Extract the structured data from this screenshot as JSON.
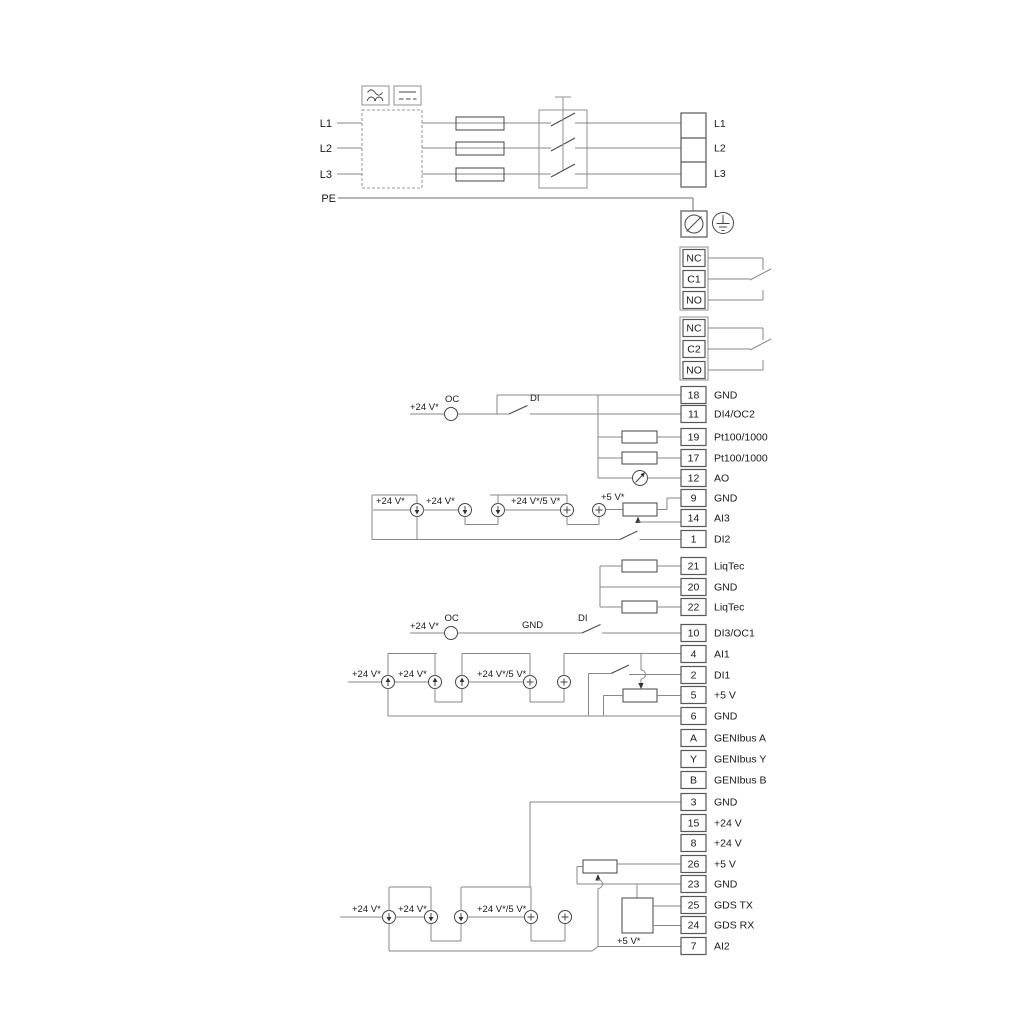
{
  "colors": {
    "background": "#ffffff",
    "wire": "#878787",
    "symbol": "#454545",
    "text": "#1a1a1a"
  },
  "power_input": {
    "lines": [
      "L1",
      "L2",
      "L3"
    ],
    "pe": "PE"
  },
  "power_output": {
    "lines": [
      "L1",
      "L2",
      "L3"
    ]
  },
  "relays": [
    {
      "t": [
        "NC",
        "C1",
        "NO"
      ]
    },
    {
      "t": [
        "NC",
        "C2",
        "NO"
      ]
    }
  ],
  "terminals": [
    {
      "n": "18",
      "l": "GND"
    },
    {
      "n": "11",
      "l": "DI4/OC2"
    },
    {
      "n": "19",
      "l": "Pt100/1000"
    },
    {
      "n": "17",
      "l": "Pt100/1000"
    },
    {
      "n": "12",
      "l": "AO"
    },
    {
      "n": "9",
      "l": "GND"
    },
    {
      "n": "14",
      "l": "AI3"
    },
    {
      "n": "1",
      "l": "DI2"
    },
    {
      "n": "21",
      "l": "LiqTec"
    },
    {
      "n": "20",
      "l": "GND"
    },
    {
      "n": "22",
      "l": "LiqTec"
    },
    {
      "n": "10",
      "l": "DI3/OC1"
    },
    {
      "n": "4",
      "l": "AI1"
    },
    {
      "n": "2",
      "l": "DI1"
    },
    {
      "n": "5",
      "l": "+5 V"
    },
    {
      "n": "6",
      "l": "GND"
    },
    {
      "n": "A",
      "l": "GENIbus A"
    },
    {
      "n": "Y",
      "l": "GENIbus Y"
    },
    {
      "n": "B",
      "l": "GENIbus B"
    },
    {
      "n": "3",
      "l": "GND"
    },
    {
      "n": "15",
      "l": "+24 V"
    },
    {
      "n": "8",
      "l": "+24 V"
    },
    {
      "n": "26",
      "l": "+5 V"
    },
    {
      "n": "23",
      "l": "GND"
    },
    {
      "n": "25",
      "l": "GDS TX"
    },
    {
      "n": "24",
      "l": "GDS RX"
    },
    {
      "n": "7",
      "l": "AI2"
    }
  ],
  "wire_labels": {
    "v24": "+24 V*",
    "v24_5": "+24 V*/5 V*",
    "v5": "+5 V*",
    "oc": "OC",
    "di": "DI",
    "gnd": "GND"
  }
}
